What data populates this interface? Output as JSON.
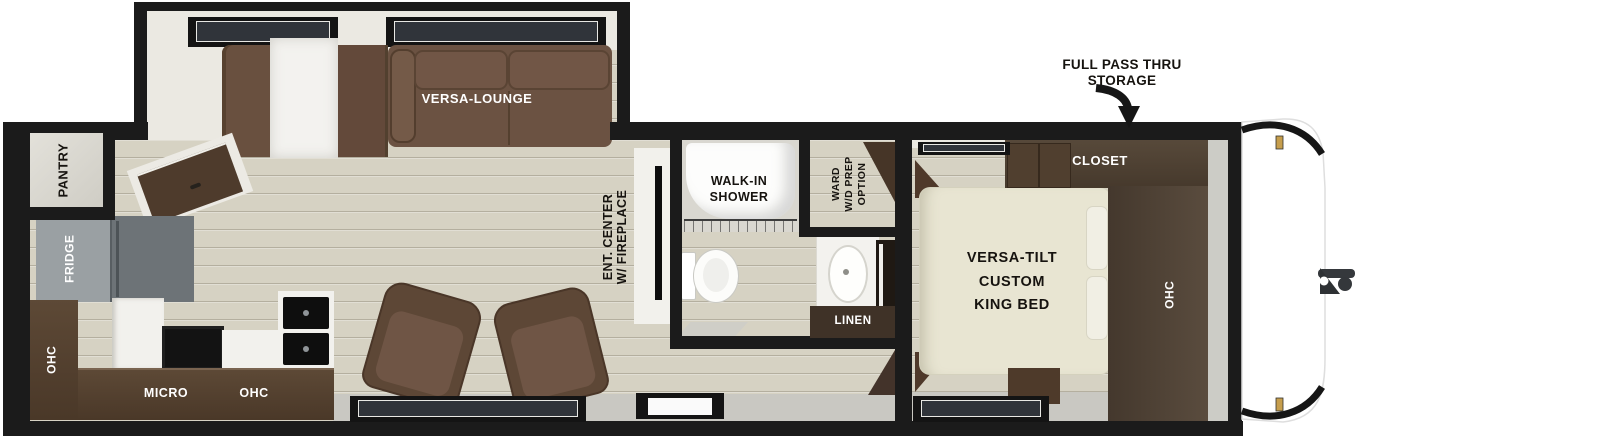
{
  "plan": {
    "annotation": {
      "line1": "FULL PASS THRU",
      "line2": "STORAGE"
    },
    "slideout": {
      "lounge": "VERSA-LOUNGE"
    },
    "rear": {
      "pantry": "PANTRY"
    },
    "kitchen": {
      "fridge": "FRIDGE",
      "ohc_tall": "OHC",
      "micro": "MICRO",
      "ohc_overhead": "OHC"
    },
    "living": {
      "ent_center_line1": "ENT. CENTER",
      "ent_center_line2": "W/ FIREPLACE"
    },
    "bathroom": {
      "shower_line1": "WALK-IN",
      "shower_line2": "SHOWER",
      "ward_line1": "WARD",
      "ward_line2": "W/D PREP",
      "ward_line3": "OPTION",
      "linen": "LINEN"
    },
    "bedroom": {
      "bed_line1": "VERSA-TILT",
      "bed_line2": "CUSTOM",
      "bed_line3": "KING BED",
      "closet": "CLOSET",
      "ohc": "OHC"
    }
  },
  "colors": {
    "wall": "#1b1b1b",
    "floor_wood": "#d6d2c3",
    "walkway_gray": "#c9c8c2",
    "cabinet_dark": "#4d3b2c",
    "sofa_brown": "#6b5241",
    "bed_cream": "#e8e5d2",
    "fridge_gray": "#9aa0a3",
    "hinge_gold": "#c69e4d",
    "glass_teal": "#cfe5e1"
  }
}
